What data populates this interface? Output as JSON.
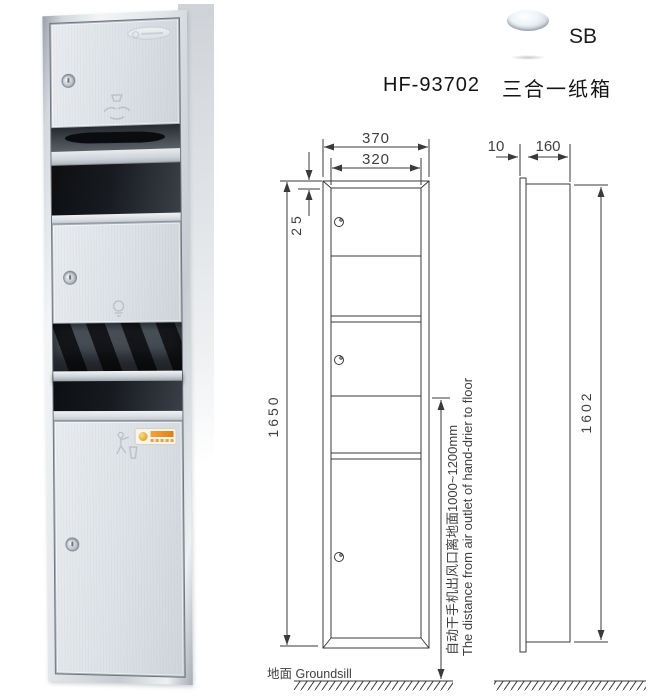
{
  "header": {
    "model": "HF-93702",
    "product_name": "三合一纸箱",
    "finish_label": "SB",
    "finish_icon": "chrome-cylinder-icon"
  },
  "photo": {
    "icons": {
      "brand_logo": "brand-logo-emboss",
      "lock": "keyhole-lock",
      "top_door_icon": "hands-under-towel-icon",
      "mid_door_icon": "hand-dryer-icon",
      "bottom_door_icon": "litter-disposal-icon",
      "sticker": "orange-warning-label"
    }
  },
  "front_view": {
    "dim_outer_width": "370",
    "dim_inner_width": "320",
    "dim_top_inset": "25",
    "dim_height": "1650",
    "note_cn": "自动干手机出风口离地面1000~1200mm",
    "note_en": "The distance from air outlet of hand-drier to floor",
    "ground_label": "地面 Groundsill"
  },
  "side_view": {
    "dim_flange": "10",
    "dim_depth": "160",
    "dim_height": "1602"
  },
  "colors": {
    "drawing_line": "#3a3a3a",
    "dim_text": "#3f3f3f",
    "steel_light": "#eef1f3",
    "steel_dark": "#9aa1a9",
    "recess_dark": "#14171b",
    "label_orange": "#de8112",
    "label_gold": "#e0a82a"
  }
}
